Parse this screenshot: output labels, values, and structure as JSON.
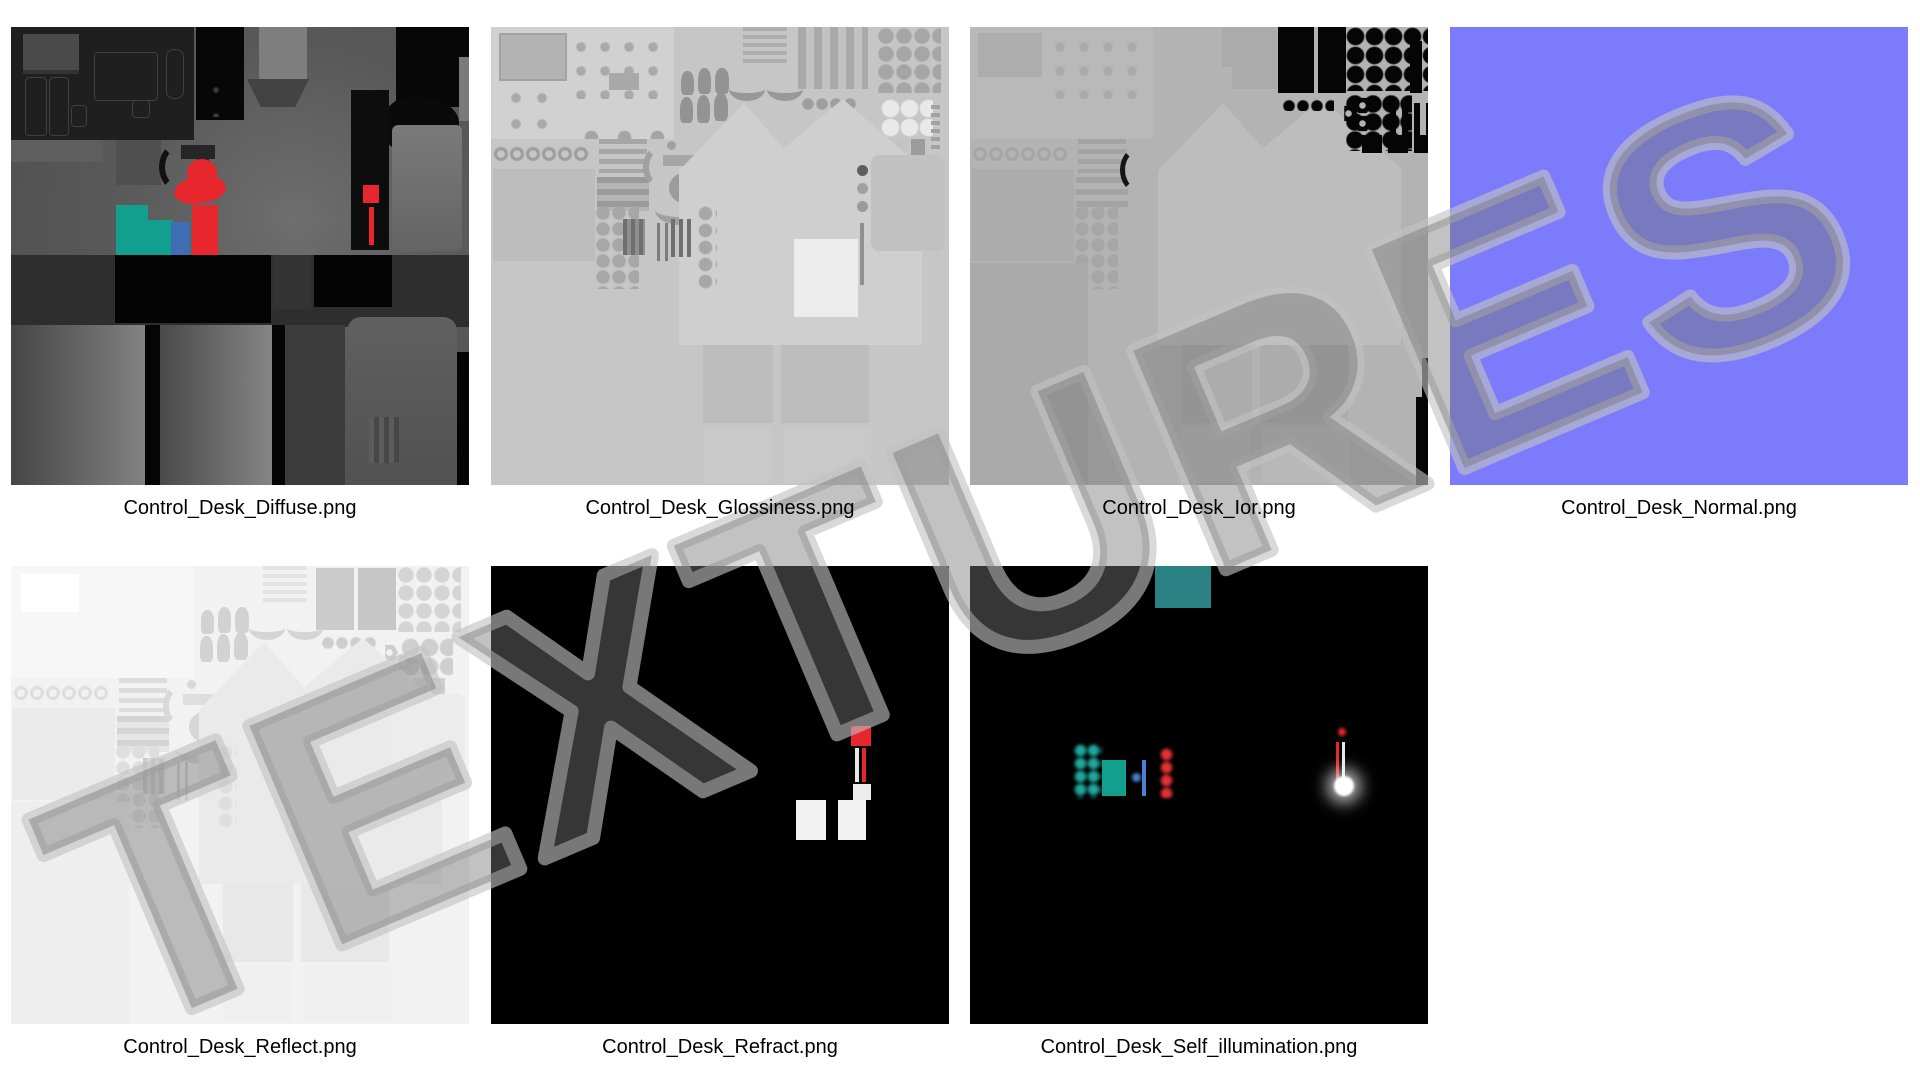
{
  "watermark": {
    "text": "TEXTURES"
  },
  "tiles": [
    {
      "id": "diffuse",
      "label": "Control_Desk_Diffuse.png"
    },
    {
      "id": "glossiness",
      "label": "Control_Desk_Glossiness.png"
    },
    {
      "id": "ior",
      "label": "Control_Desk_Ior.png"
    },
    {
      "id": "normal",
      "label": "Control_Desk_Normal.png"
    },
    {
      "id": "reflect",
      "label": "Control_Desk_Reflect.png"
    },
    {
      "id": "refract",
      "label": "Control_Desk_Refract.png"
    },
    {
      "id": "self_illumination",
      "label": "Control_Desk_Self_illumination.png"
    }
  ],
  "colors": {
    "page_bg": "#ffffff",
    "label_text": "#000000",
    "normal_map": "#7b7bfc",
    "teal": "#12a08e",
    "teal_dark": "#2a8184",
    "teal_glow": "#1fa79c",
    "red": "#e8262d",
    "blue": "#3f6eb5",
    "blue_light": "#4a7fd4",
    "white_accent": "#f2f2f2",
    "diffuse_panel_dark": "#1f1f1f",
    "gloss_base": "#c6c6c6",
    "ior_base": "#b3b3b3",
    "reflect_base": "#f2f2f2",
    "black_base": "#000000",
    "watermark_fill": "rgba(120,120,120,0.45)",
    "watermark_stroke": "rgba(194,194,194,0.62)"
  }
}
